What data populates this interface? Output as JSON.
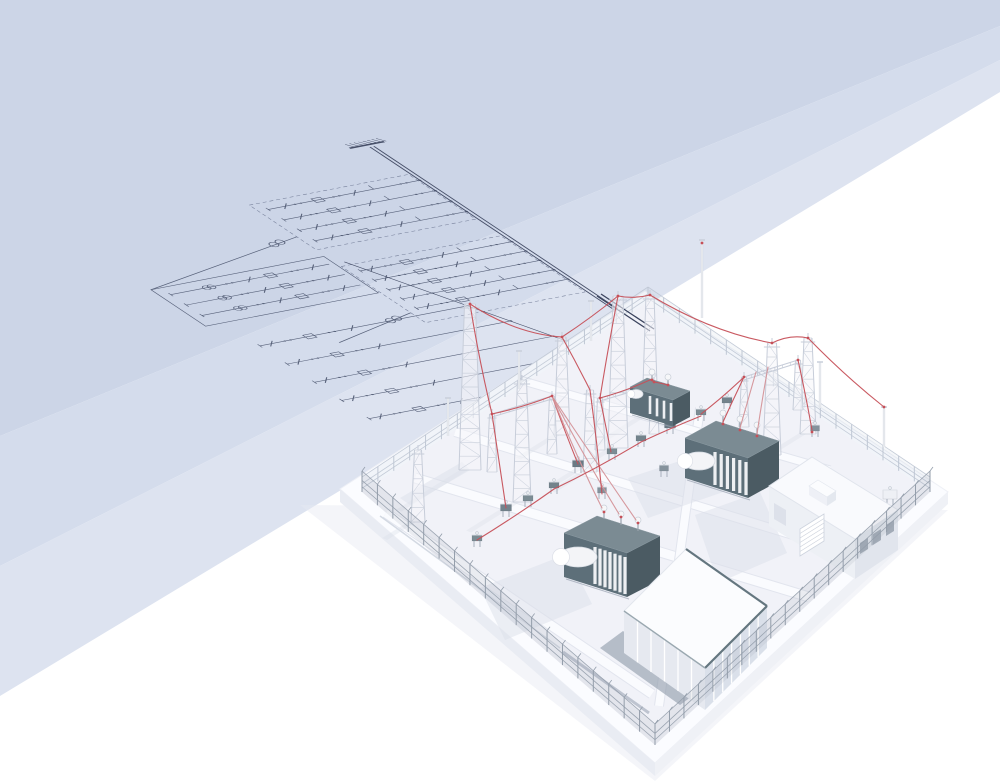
{
  "meta": {
    "description": "Isometric 3D illustration of a high-voltage electrical substation with a perspective single-line diagram drawn on a folded blue plane",
    "canvas": {
      "width": 1000,
      "height": 781
    }
  },
  "palette": {
    "plane_dark": "#ccd5e7",
    "plane_mid": "#d4dcec",
    "plane_light": "#dde3f0",
    "ink": "#4d5770",
    "ink_dark": "#3b445e",
    "dash_ink": "#6d7792",
    "ground": "#f1f2f8",
    "slab": "#fbfcff",
    "slab_side": "#e9ecf3",
    "shadow": "#dbdfe9",
    "steel": "#c7cdd9",
    "steel_fill": "#f5f6fa",
    "fence_back": "#bfc7d4",
    "fence_front": "#939daa",
    "teal_top": "#7b8b93",
    "teal_front": "#5d6f79",
    "teal_side": "#4b5b63",
    "fin_white": "#edeff2",
    "tank_white": "#f3f4f7",
    "cable_red": "#c65058",
    "cable_pink": "#d49298",
    "building_roof": "#f9fafd",
    "hall_trim": "#64767f"
  },
  "background": {
    "bands": [
      {
        "pts": [
          [
            0,
            0
          ],
          [
            1000,
            0
          ],
          [
            1000,
            26
          ],
          [
            0,
            436
          ]
        ],
        "fill": "#ccd5e7"
      },
      {
        "pts": [
          [
            0,
            436
          ],
          [
            1000,
            26
          ],
          [
            1000,
            60
          ],
          [
            0,
            566
          ]
        ],
        "fill": "#d4dcec"
      },
      {
        "pts": [
          [
            0,
            566
          ],
          [
            1000,
            60
          ],
          [
            1000,
            92
          ],
          [
            0,
            696
          ]
        ],
        "fill": "#dde3f0"
      }
    ]
  },
  "diagram": {
    "matrix": [
      0.96,
      -0.185,
      0.78,
      0.52,
      370,
      147
    ],
    "bus": {
      "x": [
        0,
        4
      ],
      "v0": 0,
      "v1": 360
    },
    "source": {
      "halfw": 18
    },
    "bays": [
      {
        "rect": [
          -168,
          52,
          166,
          86
        ],
        "feeders": [
          64,
          84,
          104,
          124
        ],
        "x0": -158,
        "x1": 0,
        "slash": [
          -140,
          -68
        ],
        "dots": [
          -130,
          -124,
          -90,
          -84,
          -20,
          -14
        ],
        "box": -106,
        "tick": -48
      },
      {
        "rect": [
          -168,
          170,
          166,
          108
        ],
        "feeders": [
          182,
          200,
          218,
          236,
          254
        ],
        "x0": -158,
        "x1": 0,
        "slash": [
          -146,
          -72
        ],
        "dots": [
          -132,
          -126,
          -94,
          -88,
          -22,
          -16
        ],
        "box": -110,
        "tick": -52
      }
    ],
    "left_box": {
      "rect": [
        -350,
        150,
        180,
        70
      ],
      "feeders": [
        163,
        183,
        203
      ],
      "x0": -340,
      "x1": -175,
      "tr": -300,
      "dots": [
        -282,
        -276,
        -214,
        -208
      ],
      "slash": [
        -258,
        -192
      ],
      "box": -236
    },
    "collector": {
      "from": [
        -160,
        164
      ],
      "to": [
        -48,
        408
      ]
    },
    "lower_feeders": {
      "x0": -330,
      "rows": [
        [
          265,
          -113
        ],
        [
          300,
          -97
        ],
        [
          335,
          -81
        ],
        [
          370,
          -65
        ],
        [
          405,
          -48
        ]
      ],
      "slash_rel": [
        12,
        96
      ],
      "dots_rel": [
        26,
        32,
        72,
        78
      ],
      "box_rel": 52
    },
    "couplings": [
      {
        "line": [
          [
            -168,
            113
          ],
          [
            -350,
            150
          ]
        ],
        "circles": [
          [
            -196,
            118
          ],
          [
            -188,
            116
          ]
        ]
      },
      {
        "line": [
          [
            -168,
            259
          ],
          [
            -262,
            283
          ]
        ],
        "circles": [
          [
            -194,
            265
          ],
          [
            -186,
            263
          ]
        ]
      }
    ],
    "bus_extension": [
      [
        597,
        296
      ],
      [
        650,
        331
      ]
    ]
  },
  "substation": {
    "platform": {
      "top": [
        [
          645,
          291
        ],
        [
          948,
          492
        ],
        [
          655,
          763
        ],
        [
          340,
          489
        ]
      ],
      "side_left": [
        [
          340,
          489
        ],
        [
          655,
          763
        ],
        [
          655,
          776
        ],
        [
          340,
          502
        ]
      ],
      "side_right": [
        [
          655,
          763
        ],
        [
          948,
          492
        ],
        [
          948,
          504
        ],
        [
          655,
          776
        ]
      ],
      "under": [
        [
          300,
          505
        ],
        [
          655,
          781
        ],
        [
          948,
          510
        ]
      ]
    },
    "yard": [
      [
        648,
        302
      ],
      [
        930,
        492
      ],
      [
        655,
        745
      ],
      [
        362,
        492
      ]
    ],
    "roads": [
      {
        "a": [
          386,
          513
        ],
        "b": [
          652,
          694
        ],
        "w": 9
      },
      {
        "a": [
          415,
          478
        ],
        "b": [
          809,
          597
        ],
        "w": 9
      },
      {
        "a": [
          455,
          432
        ],
        "b": [
          862,
          556
        ],
        "w": 8
      },
      {
        "a": [
          700,
          408
        ],
        "b": [
          659,
          706
        ],
        "w": 8
      },
      {
        "a": [
          520,
          380
        ],
        "b": [
          830,
          470
        ],
        "w": 7
      }
    ],
    "trenches": [
      {
        "a": [
          563,
          652
        ],
        "b": [
          649,
          713
        ],
        "w": 3,
        "c": "#b6bdca"
      },
      {
        "a": [
          380,
          516
        ],
        "b": [
          560,
          648
        ],
        "w": 1.5,
        "c": "#cdd3de"
      }
    ],
    "shadows": [
      [
        [
          480,
          588
        ],
        [
          567,
          554
        ],
        [
          592,
          604
        ],
        [
          505,
          640
        ]
      ],
      [
        [
          628,
          478
        ],
        [
          713,
          450
        ],
        [
          729,
          490
        ],
        [
          648,
          518
        ]
      ],
      [
        [
          695,
          515
        ],
        [
          760,
          492
        ],
        [
          787,
          553
        ],
        [
          718,
          583
        ]
      ],
      [
        [
          470,
          470
        ],
        [
          410,
          505
        ],
        [
          400,
          498
        ],
        [
          462,
          462
        ]
      ]
    ],
    "fence_back": [
      {
        "a": [
          362,
          492
        ],
        "b": [
          648,
          302
        ],
        "h": 15,
        "n": 18
      },
      {
        "a": [
          648,
          302
        ],
        "b": [
          930,
          492
        ],
        "h": 15,
        "n": 18
      }
    ],
    "fence_front": [
      {
        "a": [
          930,
          492
        ],
        "b": [
          655,
          745
        ],
        "h": 21,
        "n": 19
      },
      {
        "a": [
          655,
          745
        ],
        "b": [
          362,
          492
        ],
        "h": 21,
        "n": 19
      }
    ],
    "towers": [
      [
        618,
        448,
        152,
        10
      ],
      [
        650,
        415,
        120,
        8
      ],
      [
        470,
        470,
        166,
        11
      ],
      [
        522,
        502,
        122,
        9
      ],
      [
        562,
        435,
        98,
        8
      ],
      [
        772,
        455,
        112,
        9
      ],
      [
        808,
        434,
        96,
        8
      ],
      [
        418,
        522,
        72,
        7
      ],
      [
        590,
        472,
        82,
        7
      ]
    ],
    "gantries": [
      {
        "p1": [
          492,
          472
        ],
        "p2": [
          552,
          454
        ],
        "h": 58
      },
      {
        "p1": [
          600,
          450
        ],
        "p2": [
          654,
          434
        ],
        "h": 52
      },
      {
        "p1": [
          744,
          427
        ],
        "p2": [
          798,
          410
        ],
        "h": 50
      }
    ],
    "equipment": [
      [
        506,
        517,
        11,
        7,
        "#73838c"
      ],
      [
        528,
        507,
        10,
        6,
        "#7c8c94"
      ],
      [
        554,
        494,
        10,
        6,
        "#73838c"
      ],
      [
        578,
        473,
        11,
        7,
        "#6a7a84"
      ],
      [
        612,
        460,
        10,
        6,
        "#7c8c94"
      ],
      [
        641,
        447,
        10,
        6,
        "#73838c"
      ],
      [
        670,
        434,
        11,
        7,
        "#6a7a84"
      ],
      [
        701,
        421,
        10,
        6,
        "#7c8c94"
      ],
      [
        727,
        409,
        10,
        6,
        "#73838c"
      ],
      [
        477,
        547,
        10,
        6,
        "#7c8c94"
      ],
      [
        602,
        499,
        9,
        6,
        "#85929c"
      ],
      [
        664,
        477,
        9,
        6,
        "#85929c"
      ],
      [
        742,
        466,
        9,
        6,
        "#7c8c94"
      ],
      [
        700,
        452,
        9,
        6,
        "#85929c"
      ],
      [
        815,
        437,
        9,
        6,
        "#85929c"
      ],
      [
        890,
        505,
        14,
        9,
        "#eef0f5"
      ]
    ],
    "transformers": [
      {
        "top": [
          [
            647,
            378
          ],
          [
            690,
            391
          ],
          [
            673,
            400
          ],
          [
            630,
            387
          ]
        ],
        "h": 26,
        "fins": {
          "a": [
            650,
            393
          ],
          "b": [
            671,
            400
          ],
          "n": 4,
          "len": 18,
          "w": 2.6,
          "drop": 3
        },
        "tank": {
          "cx": 636,
          "cy": 394,
          "rx": 7,
          "ry": 4.5
        },
        "bushings": [
          [
            652,
            381
          ],
          [
            668,
            386
          ]
        ],
        "stalk": 7
      },
      {
        "top": [
          [
            716,
            421
          ],
          [
            779,
            441
          ],
          [
            748,
            458
          ],
          [
            685,
            438
          ]
        ],
        "h": 40,
        "fins": {
          "a": [
            715,
            448
          ],
          "b": [
            746,
            458
          ],
          "n": 6,
          "len": 33,
          "w": 3.2,
          "drop": 4
        },
        "tank": {
          "cx": 699,
          "cy": 461,
          "rx": 16,
          "ry": 9
        },
        "bushings": [
          [
            723,
            424
          ],
          [
            740,
            430
          ],
          [
            757,
            436
          ]
        ],
        "stalk": 9
      },
      {
        "top": [
          [
            597,
            516
          ],
          [
            660,
            536
          ],
          [
            627,
            553
          ],
          [
            564,
            533
          ]
        ],
        "h": 44,
        "fins": {
          "a": [
            595,
            543
          ],
          "b": [
            625,
            553
          ],
          "n": 7,
          "len": 37,
          "w": 3.2,
          "drop": 4
        },
        "tank": {
          "cx": 578,
          "cy": 557,
          "rx": 19,
          "ry": 10
        },
        "bushings": [
          [
            604,
            519
          ],
          [
            621,
            525
          ],
          [
            638,
            531
          ]
        ],
        "stalk": 9
      }
    ],
    "control_building": {
      "roof": [
        [
          812,
          457
        ],
        [
          898,
          510
        ],
        [
          855,
          539
        ],
        [
          769,
          486
        ]
      ],
      "wall_h": 40,
      "vent": [
        [
          818,
          480
        ],
        [
          836,
          491
        ],
        [
          827,
          497
        ],
        [
          809,
          486
        ]
      ],
      "vent_h": 9,
      "windows": [
        [
          860,
          543
        ],
        [
          873,
          534
        ],
        [
          886,
          525
        ]
      ],
      "stairs": [
        [
          800,
          556
        ],
        [
          824,
          541
        ],
        [
          824,
          514
        ],
        [
          800,
          529
        ]
      ],
      "door": [
        [
          774,
          503
        ],
        [
          786,
          510
        ],
        [
          786,
          526
        ],
        [
          774,
          519
        ]
      ]
    },
    "hall_building": {
      "roof": [
        [
          686,
          549
        ],
        [
          767,
          606
        ],
        [
          705,
          668
        ],
        [
          624,
          611
        ]
      ],
      "wall_h": 42,
      "mull_se": 7,
      "mull_sw": 6,
      "base_strip": [
        [
          600,
          648
        ],
        [
          623,
          631
        ],
        [
          703,
          688
        ],
        [
          680,
          705
        ]
      ]
    },
    "poles": [
      [
        702,
        318,
        78
      ],
      [
        448,
        436,
        38
      ],
      [
        519,
        389,
        38
      ],
      [
        591,
        341,
        40
      ],
      [
        820,
        408,
        46
      ],
      [
        884,
        447,
        40
      ]
    ],
    "cables": [
      {
        "d": "M470,304 Q516,334 562,337"
      },
      {
        "d": "M562,337 Q591,318 618,296"
      },
      {
        "d": "M618,296 Q634,299 650,295"
      },
      {
        "d": "M650,295 Q711,332 772,343"
      },
      {
        "d": "M772,343 Q790,334 808,338"
      },
      {
        "d": "M808,338 Q845,376 884,407"
      },
      {
        "d": "M470,304 Q479,360 492,414"
      },
      {
        "d": "M492,414 Q524,407 552,396"
      },
      {
        "d": "M492,414 Q499,462 506,508"
      },
      {
        "d": "M552,396 Q565,432 578,464"
      },
      {
        "d": "M552,396 Q577,458 602,508",
        "c": "#d49298"
      },
      {
        "d": "M552,396 Q586,460 619,514",
        "c": "#d49298"
      },
      {
        "d": "M552,396 Q596,462 636,520",
        "c": "#d49298"
      },
      {
        "d": "M618,296 Q608,348 600,398"
      },
      {
        "d": "M600,398 Q626,391 652,379"
      },
      {
        "d": "M600,398 Q606,428 611,452"
      },
      {
        "d": "M654,382 Q661,383 668,385"
      },
      {
        "d": "M744,377 Q733,400 723,422"
      },
      {
        "d": "M756,372 Q748,400 740,428",
        "c": "#d49298"
      },
      {
        "d": "M768,367 Q762,400 757,434",
        "c": "#d49298"
      },
      {
        "d": "M744,377 Q722,398 701,414"
      },
      {
        "d": "M798,360 Q806,396 812,430"
      },
      {
        "d": "M477,540 Q516,516 554,489"
      },
      {
        "d": "M554,489 Q598,468 641,442"
      },
      {
        "d": "M641,442 Q671,428 701,416"
      },
      {
        "d": "M562,337 Q577,364 590,390"
      },
      {
        "d": "M590,390 Q597,442 602,494"
      }
    ],
    "cable_dots": [
      [
        470,
        304
      ],
      [
        562,
        337
      ],
      [
        618,
        296
      ],
      [
        650,
        295
      ],
      [
        772,
        343
      ],
      [
        808,
        338
      ],
      [
        884,
        407
      ],
      [
        492,
        414
      ],
      [
        552,
        396
      ],
      [
        600,
        398
      ],
      [
        654,
        382
      ],
      [
        744,
        377
      ],
      [
        798,
        360
      ],
      [
        702,
        243
      ],
      [
        604,
        512
      ],
      [
        621,
        517
      ],
      [
        638,
        523
      ],
      [
        723,
        424
      ],
      [
        740,
        430
      ],
      [
        757,
        436
      ],
      [
        652,
        380
      ],
      [
        668,
        385
      ],
      [
        812,
        432
      ]
    ]
  }
}
